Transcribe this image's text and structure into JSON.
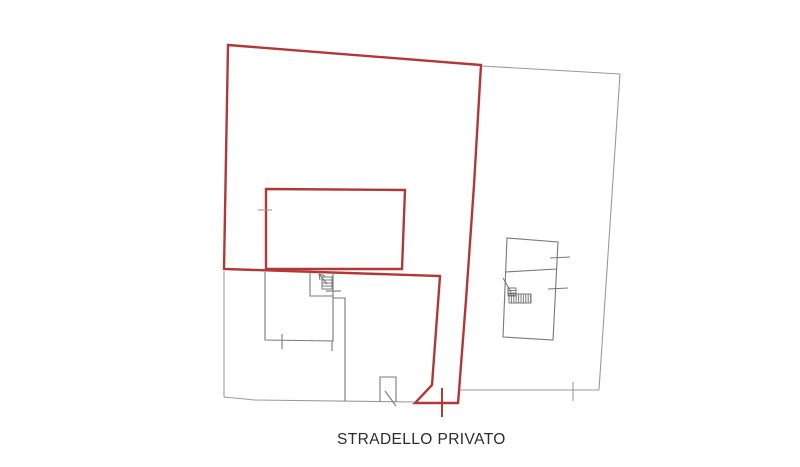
{
  "canvas": {
    "width": 800,
    "height": 467,
    "background": "#ffffff"
  },
  "palette": {
    "red": "#b23838",
    "gray": "#9a9a9a",
    "dark": "#787878",
    "text": "#2b2b2b"
  },
  "label": {
    "text": "STRADELLO PRIVATO"
  },
  "geometry": {
    "paths": [
      {
        "name": "red-parcel-boundary",
        "stroke": "red",
        "width": 2.4,
        "closed": true,
        "points": [
          [
            228,
            45
          ],
          [
            481,
            65
          ],
          [
            474,
            185
          ],
          [
            466,
            300
          ],
          [
            459,
            391
          ],
          [
            458,
            403
          ],
          [
            415,
            403
          ],
          [
            432,
            385
          ],
          [
            440,
            276
          ],
          [
            224,
            269
          ]
        ]
      },
      {
        "name": "red-building-outline",
        "stroke": "red",
        "width": 2.4,
        "closed": true,
        "points": [
          [
            266,
            189
          ],
          [
            405,
            190
          ],
          [
            402,
            269
          ],
          [
            266,
            269
          ]
        ]
      },
      {
        "name": "red-survey-cross",
        "stroke": "red",
        "width": 2,
        "closed": false,
        "points": [
          [
            442,
            388
          ],
          [
            442,
            417
          ]
        ]
      },
      {
        "name": "left-parcel-west-edge",
        "stroke": "gray",
        "width": 1.1,
        "closed": false,
        "points": [
          [
            224,
            271
          ],
          [
            224,
            397
          ]
        ]
      },
      {
        "name": "left-parcel-south-edge",
        "stroke": "gray",
        "width": 1.1,
        "closed": false,
        "points": [
          [
            224,
            397
          ],
          [
            255,
            400
          ],
          [
            415,
            402
          ]
        ]
      },
      {
        "name": "right-parcel-north-edge",
        "stroke": "gray",
        "width": 1.1,
        "closed": false,
        "points": [
          [
            482,
            66
          ],
          [
            620,
            74
          ]
        ]
      },
      {
        "name": "right-parcel-east-edge",
        "stroke": "gray",
        "width": 1.1,
        "closed": false,
        "points": [
          [
            620,
            74
          ],
          [
            603,
            330
          ],
          [
            599,
            390
          ]
        ]
      },
      {
        "name": "right-parcel-south-edge",
        "stroke": "gray",
        "width": 1.1,
        "closed": false,
        "points": [
          [
            599,
            390
          ],
          [
            460,
            390
          ]
        ]
      },
      {
        "name": "south-edge-survey-tick",
        "stroke": "gray",
        "width": 1.1,
        "closed": false,
        "points": [
          [
            573,
            382
          ],
          [
            573,
            401
          ]
        ]
      },
      {
        "name": "red-building-wall-tick",
        "stroke": "gray",
        "width": 1.1,
        "closed": false,
        "points": [
          [
            258,
            210
          ],
          [
            272,
            210
          ]
        ]
      },
      {
        "name": "left-building-outline",
        "stroke": "dark",
        "width": 1.1,
        "closed": false,
        "points": [
          [
            265,
            272
          ],
          [
            265,
            340
          ],
          [
            333,
            341
          ],
          [
            333,
            272
          ]
        ]
      },
      {
        "name": "left-building-bottom-tick",
        "stroke": "dark",
        "width": 1.1,
        "closed": false,
        "points": [
          [
            282,
            334
          ],
          [
            282,
            349
          ]
        ]
      },
      {
        "name": "left-stair-room-walls",
        "stroke": "dark",
        "width": 1.1,
        "closed": false,
        "points": [
          [
            310,
            272
          ],
          [
            310,
            296
          ],
          [
            333,
            296
          ]
        ]
      },
      {
        "name": "left-stair-room-tick",
        "stroke": "dark",
        "width": 1.1,
        "closed": false,
        "points": [
          [
            326,
            291
          ],
          [
            341,
            291
          ]
        ]
      },
      {
        "name": "left-building-stub",
        "stroke": "dark",
        "width": 1.1,
        "closed": false,
        "points": [
          [
            332,
            341
          ],
          [
            332,
            351
          ]
        ]
      },
      {
        "name": "courtyard-fence",
        "stroke": "dark",
        "width": 1.1,
        "closed": false,
        "points": [
          [
            333,
            298
          ],
          [
            345,
            298
          ],
          [
            345,
            401
          ]
        ]
      },
      {
        "name": "gate-rectangle",
        "stroke": "dark",
        "width": 1.1,
        "closed": false,
        "points": [
          [
            380,
            402
          ],
          [
            380,
            377
          ],
          [
            396,
            377
          ],
          [
            396,
            402
          ]
        ]
      },
      {
        "name": "gate-diagonal",
        "stroke": "dark",
        "width": 1.1,
        "closed": false,
        "points": [
          [
            385,
            391
          ],
          [
            396,
            406
          ]
        ]
      },
      {
        "name": "right-building-outline",
        "stroke": "dark",
        "width": 1.1,
        "closed": true,
        "points": [
          [
            507,
            238
          ],
          [
            558,
            242
          ],
          [
            553,
            340
          ],
          [
            503,
            337
          ]
        ]
      },
      {
        "name": "right-building-division",
        "stroke": "dark",
        "width": 1.1,
        "closed": false,
        "points": [
          [
            505,
            272
          ],
          [
            557,
            269
          ]
        ]
      },
      {
        "name": "right-building-tick-upper",
        "stroke": "dark",
        "width": 1.1,
        "closed": false,
        "points": [
          [
            550,
            258
          ],
          [
            570,
            257
          ]
        ]
      },
      {
        "name": "right-building-tick-lower",
        "stroke": "dark",
        "width": 1.1,
        "closed": false,
        "points": [
          [
            548,
            289
          ],
          [
            568,
            288
          ]
        ]
      },
      {
        "name": "right-stair-diagonal",
        "stroke": "dark",
        "width": 1.1,
        "closed": false,
        "points": [
          [
            503,
            278
          ],
          [
            511,
            292
          ]
        ]
      },
      {
        "name": "left-stair-arrow-shaft",
        "stroke": "dark",
        "width": 1.1,
        "closed": false,
        "points": [
          [
            327,
            284
          ],
          [
            319,
            274
          ]
        ]
      },
      {
        "name": "left-stair-arrow-head-a",
        "stroke": "dark",
        "width": 1.1,
        "closed": false,
        "points": [
          [
            319,
            274
          ],
          [
            320,
            280
          ]
        ]
      },
      {
        "name": "left-stair-arrow-head-b",
        "stroke": "dark",
        "width": 1.1,
        "closed": false,
        "points": [
          [
            319,
            274
          ],
          [
            325,
            276
          ]
        ]
      }
    ],
    "hatches": [
      {
        "name": "left-stair-steps",
        "stroke": "dark",
        "width": 1,
        "x": 322,
        "y": 277,
        "w": 10,
        "h": 12,
        "dir": "h",
        "step": 3
      },
      {
        "name": "right-stair-steps-small",
        "stroke": "dark",
        "width": 1,
        "x": 508,
        "y": 288,
        "w": 8,
        "h": 8,
        "dir": "h",
        "step": 2.5
      },
      {
        "name": "right-stair-steps-run",
        "stroke": "dark",
        "width": 1,
        "x": 509,
        "y": 294,
        "w": 22,
        "h": 9,
        "dir": "v",
        "step": 2.4
      }
    ]
  }
}
